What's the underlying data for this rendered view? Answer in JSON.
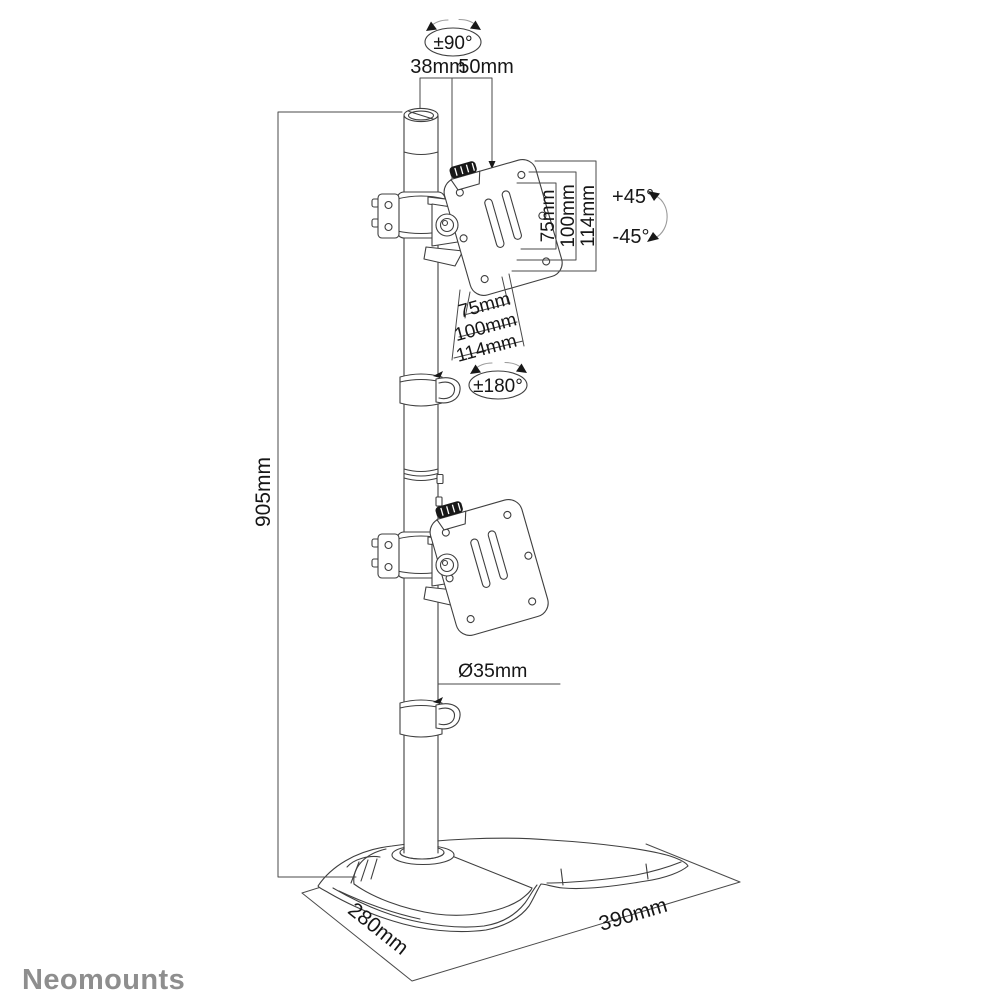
{
  "brand": {
    "logo": "Neomounts"
  },
  "labels": {
    "swivel_top": "±90°",
    "dim38": "38mm",
    "dim50": "50mm",
    "tilt_up": "+45°",
    "tilt_down": "-45°",
    "rotation_mid": "±180°",
    "height": "905mm",
    "pole_diameter": "Ø35mm",
    "base_depth": "280mm",
    "base_width": "390mm"
  },
  "vesa_vertical": [
    "75mm",
    "100mm",
    "114mm"
  ],
  "vesa_horizontal": [
    "75mm",
    "100mm",
    "114mm"
  ],
  "colors": {
    "line": "#3f3f3f",
    "text": "#161616",
    "brand": "#8e8e8e"
  }
}
